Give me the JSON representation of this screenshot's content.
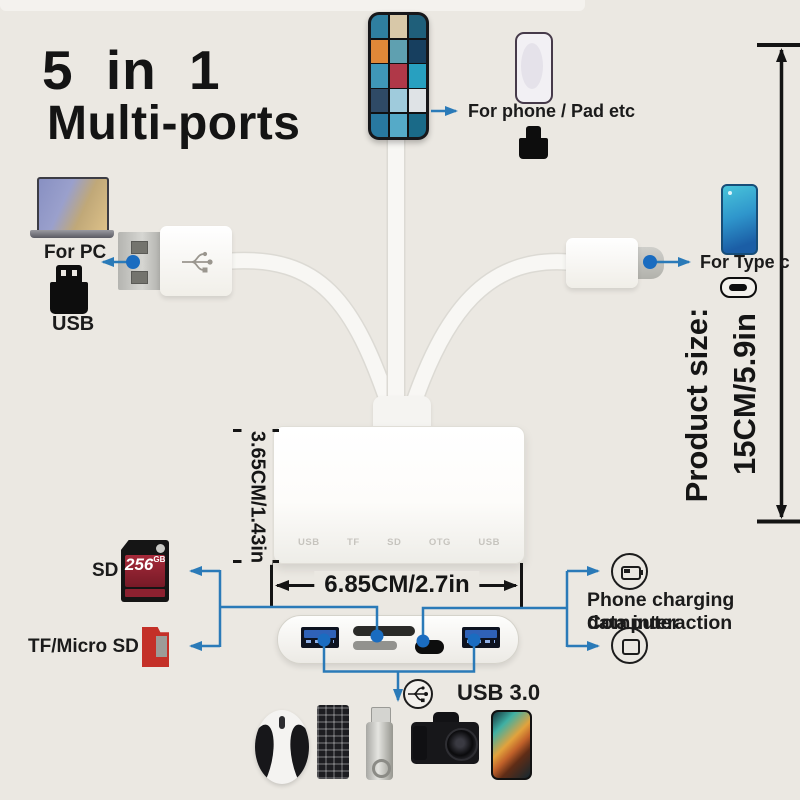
{
  "title": {
    "line1": "5 in 1",
    "line2": "Multi-ports"
  },
  "labels": {
    "for_pc": "For PC",
    "usb": "USB",
    "for_phone": "For phone / Pad etc",
    "for_type_c": "For Type c",
    "sd": "SD",
    "tf_micro_sd": "TF/Micro SD",
    "usb30": "USB 3.0",
    "charging_line1": "Phone charging Computer",
    "charging_line2": "data interaction"
  },
  "dimensions": {
    "height": "3.65CM/1.43in",
    "width": "6.85CM/2.7in",
    "size_label": "Product size:",
    "size_value": "15CM/5.9in"
  },
  "sd_card": {
    "capacity": "256",
    "unit": "GB"
  },
  "adapter": {
    "front_icons": [
      "USB",
      "TF",
      "SD",
      "OTG",
      "USB"
    ]
  },
  "phone_gallery": {
    "photos": [
      "#2f7fa0",
      "#d8c8a8",
      "#1f5f7a",
      "#e08838",
      "#5fa0b0",
      "#173f5f",
      "#3f97b8",
      "#b03848",
      "#28a0c0",
      "#2f4a66",
      "#9fcbdc",
      "#dfe3e6",
      "#2878a0",
      "#55aac8",
      "#1a6a88"
    ]
  },
  "colors": {
    "background": "#ebe8e2",
    "line_blue": "#2a7ab8",
    "dot_blue": "#1a6cc0",
    "black": "#141414",
    "usb_port_blue": "#2f62b8",
    "sd_card_red": "#8c2130",
    "tf_card_red": "#c43028"
  },
  "icons": [
    "laptop-icon",
    "usb-plug-icon",
    "phone-gallery",
    "phone-icon",
    "lightning-adapter-icon",
    "type-c-phone-icon",
    "usb-c-pill-icon",
    "battery-charging-icon",
    "computer-icon",
    "usb3-trident-icon",
    "sd-card-image",
    "tf-card-image",
    "mouse-image",
    "keyboard-image",
    "flashdrive-image",
    "camera-image",
    "phone-image"
  ]
}
